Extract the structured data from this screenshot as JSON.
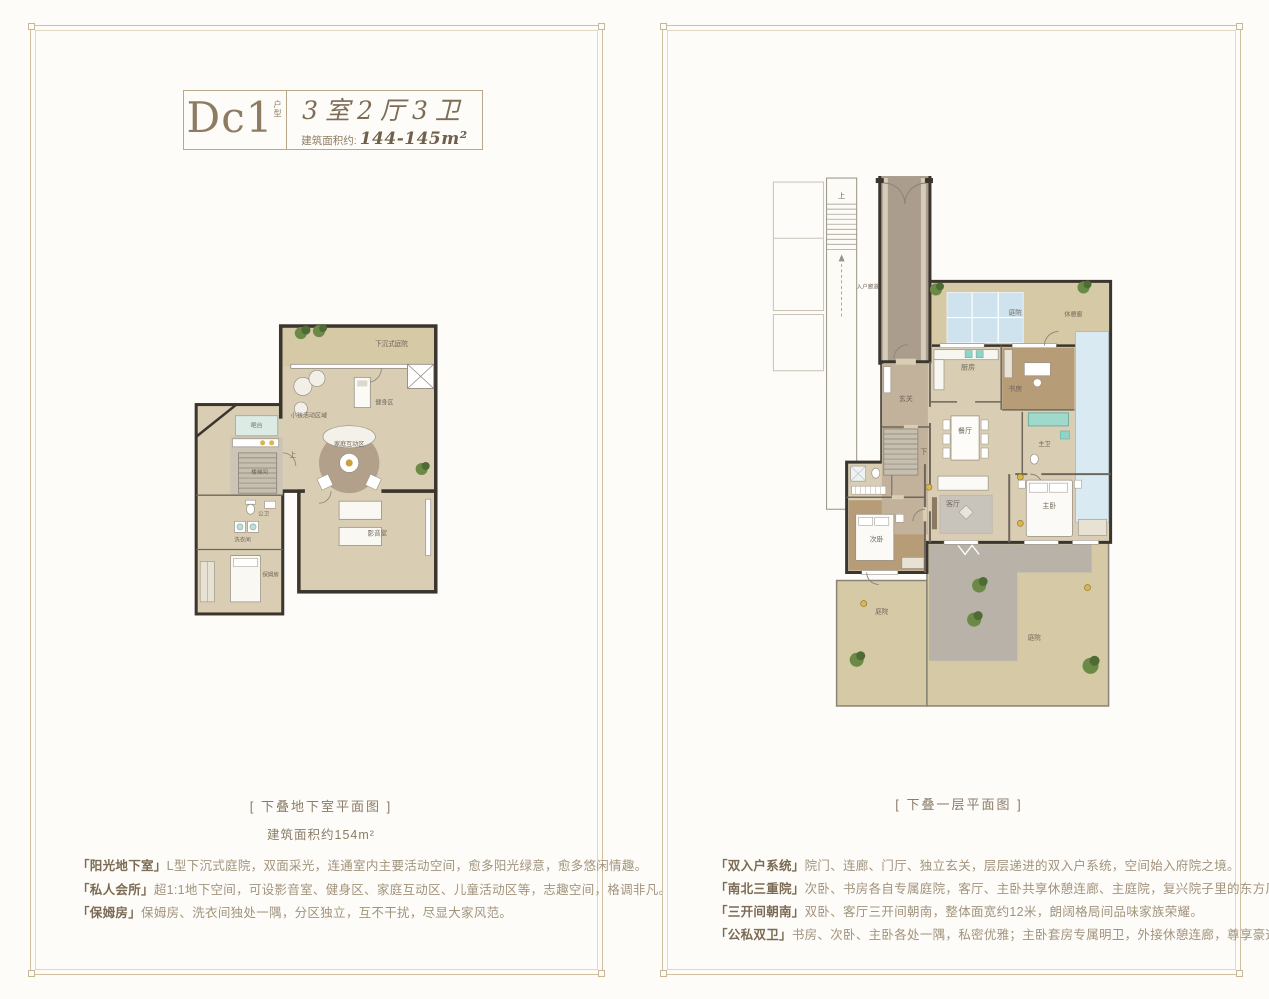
{
  "colors": {
    "frame": "#c9b695",
    "accent_brown": "#8d7b63",
    "body_text": "#a2937d",
    "title_text": "#7b6b54",
    "wall": "#3a352d",
    "floor_beige": "#d9ceb4",
    "courtyard_beige": "#d5c9a6",
    "wood_floor": "#b79c78",
    "glass_blue": "#cfe3ee",
    "paving_gray": "#b8b2a8",
    "plant_green": "#5f7d3d",
    "gold": "#d8b84a"
  },
  "header": {
    "unit_code": "Dc1",
    "unit_tag": "户型",
    "layout": "3室2厅3卫",
    "area_label": "建筑面积约:",
    "area_value": "144-145m²"
  },
  "left_panel": {
    "caption": "[ 下叠地下室平面图 ]",
    "caption_area": "建筑面积约154m²",
    "rooms": {
      "sunken_courtyard": "下沉式庭院",
      "kids_zone": "小孩活动区域",
      "fitness_zone": "健身区",
      "family_zone": "家庭互动区",
      "bar": "吧台",
      "stair_hall": "楼梯间",
      "up": "上",
      "public_wc": "公卫",
      "laundry": "洗衣间",
      "nanny_room": "保姆房",
      "av_room": "影音室"
    },
    "features": [
      {
        "title": "「阳光地下室」",
        "text": "L型下沉式庭院，双面采光，连通室内主要活动空间，愈多阳光绿意，愈多悠闲情趣。"
      },
      {
        "title": "「私人会所」",
        "text": "超1:1地下空间，可设影音室、健身区、家庭互动区、儿童活动区等，志趣空间，格调非凡。"
      },
      {
        "title": "「保姆房」",
        "text": "保姆房、洗衣间独处一隅，分区独立，互不干扰，尽显大家风范。"
      }
    ]
  },
  "right_panel": {
    "caption": "[ 下叠一层平面图 ]",
    "rooms": {
      "up": "上",
      "entry_corridor": "入户廊道",
      "north_courtyard": "庭院",
      "rest_corridor": "休憩廊",
      "kitchen": "厨房",
      "study": "书房",
      "foyer": "玄关",
      "dining": "餐厅",
      "master_bath": "主卫",
      "down": "下",
      "living": "客厅",
      "master_bedroom": "主卧",
      "second_bedroom": "次卧",
      "west_courtyard": "庭院",
      "south_courtyard": "庭院"
    },
    "features": [
      {
        "title": "「双入户系统」",
        "text": "院门、连廊、门厅、独立玄关，层层递进的双入户系统，空间始入府院之境。"
      },
      {
        "title": "「南北三重院」",
        "text": "次卧、书房各自专属庭院，客厅、主卧共享休憩连廊、主庭院，复兴院子里的东方风雅。"
      },
      {
        "title": "「三开间朝南」",
        "text": "双卧、客厅三开间朝南，整体面宽约12米，朗阔格局间品味家族荣耀。"
      },
      {
        "title": "「公私双卫」",
        "text": "书房、次卧、主卧各处一隅，私密优雅；主卧套房专属明卫，外接休憩连廊，尊享豪迈气度。"
      }
    ]
  }
}
